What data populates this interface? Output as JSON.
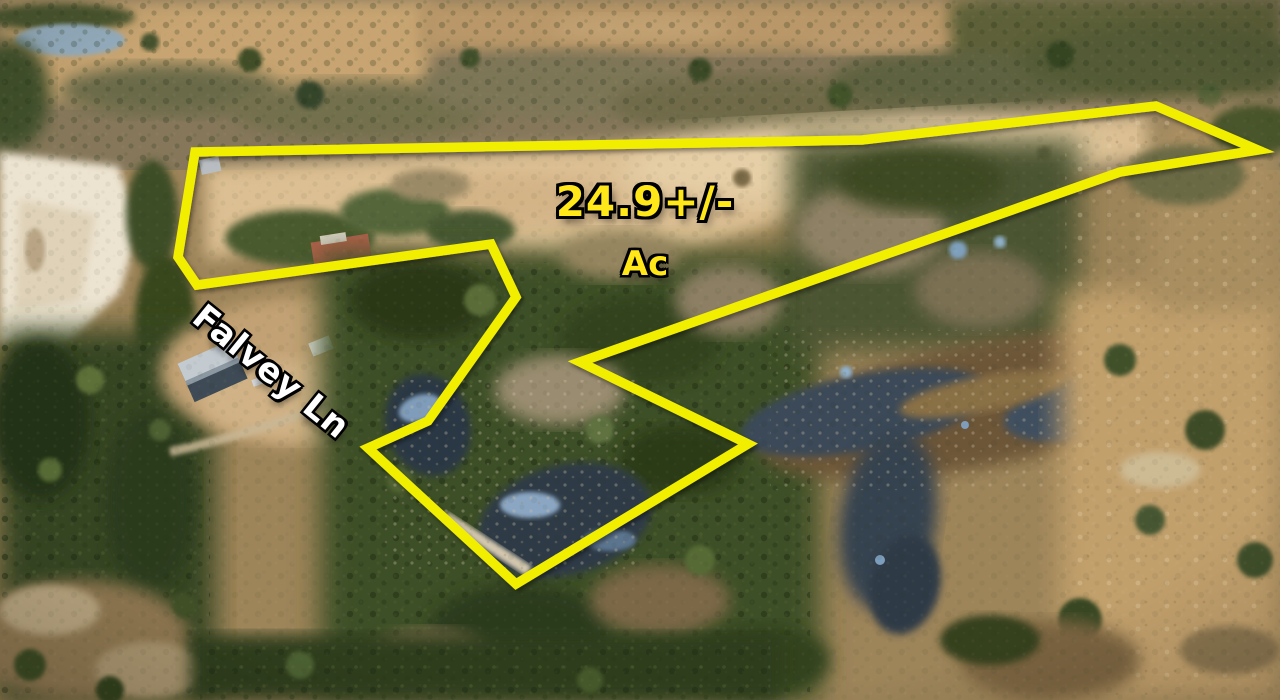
{
  "image": {
    "type": "aerial-drone-photo",
    "description": "Aerial view of rural wooded acreage with ponds, open tan pasture, a white sand pit, homes along a lane, and a yellow surveyed property-boundary overlay",
    "width_px": 1280,
    "height_px": 700
  },
  "annotations": {
    "acreage_label": {
      "line1": "24.9+/-",
      "line2": "Ac",
      "text_color": "#ffe71a",
      "outline_color": "#000000"
    },
    "road_label": {
      "text": "Falvey Ln",
      "text_color": "#ffffff",
      "outline_color": "#000000"
    }
  },
  "boundary": {
    "stroke_color": "#f2ee06",
    "stroke_width_px": 9.5,
    "points": [
      [
        195,
        152
      ],
      [
        862,
        140
      ],
      [
        1156,
        106
      ],
      [
        1258,
        150
      ],
      [
        1120,
        172
      ],
      [
        580,
        362
      ],
      [
        748,
        444
      ],
      [
        516,
        584
      ],
      [
        368,
        448
      ],
      [
        428,
        421
      ],
      [
        516,
        297
      ],
      [
        491,
        244
      ],
      [
        197,
        285
      ],
      [
        178,
        257
      ]
    ]
  },
  "palette": {
    "field_tan": "#dcbf93",
    "forest_green": "#3d4f27",
    "bare_trees": "#9a8c6f",
    "water": "#36434f",
    "sand": "#ece3d0"
  }
}
